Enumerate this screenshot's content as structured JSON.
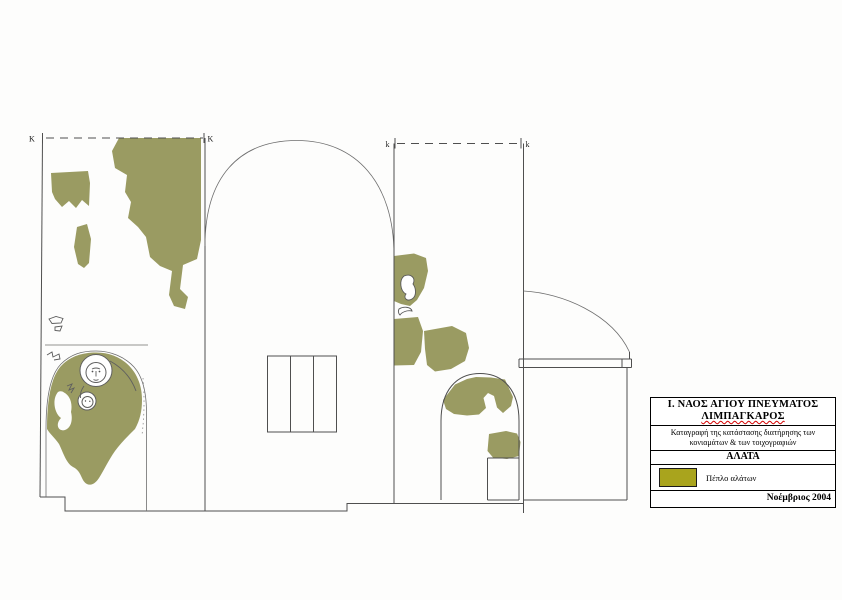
{
  "drawing": {
    "markers": {
      "left_wall_start": "K",
      "left_wall_end": "K",
      "right_wall_start": "k",
      "right_wall_end": "k"
    }
  },
  "title_block": {
    "title_line1": "Ι. ΝΑΟΣ ΑΓΙΟΥ ΠΝΕΥΜΑΤΟΣ",
    "title_line2": "ΛΙΜΠΑΓΚΑΡΟΣ",
    "description_line1": "Καταγραφή της κατάστασης διατήρησης των",
    "description_line2": "κονιαμάτων & των τοιχογραφιών",
    "section_label": "ΑΛΑΤΑ",
    "legend": {
      "label": "Πέπλο αλάτων"
    },
    "date": "Νοέμβριος 2004"
  },
  "colors": {
    "background": "#fdfdfc",
    "line": "#4f4f4f",
    "salt_area": "#9a9b62",
    "legend_swatch": "#a9a41d",
    "spellcheck_underline": "#d40000"
  }
}
